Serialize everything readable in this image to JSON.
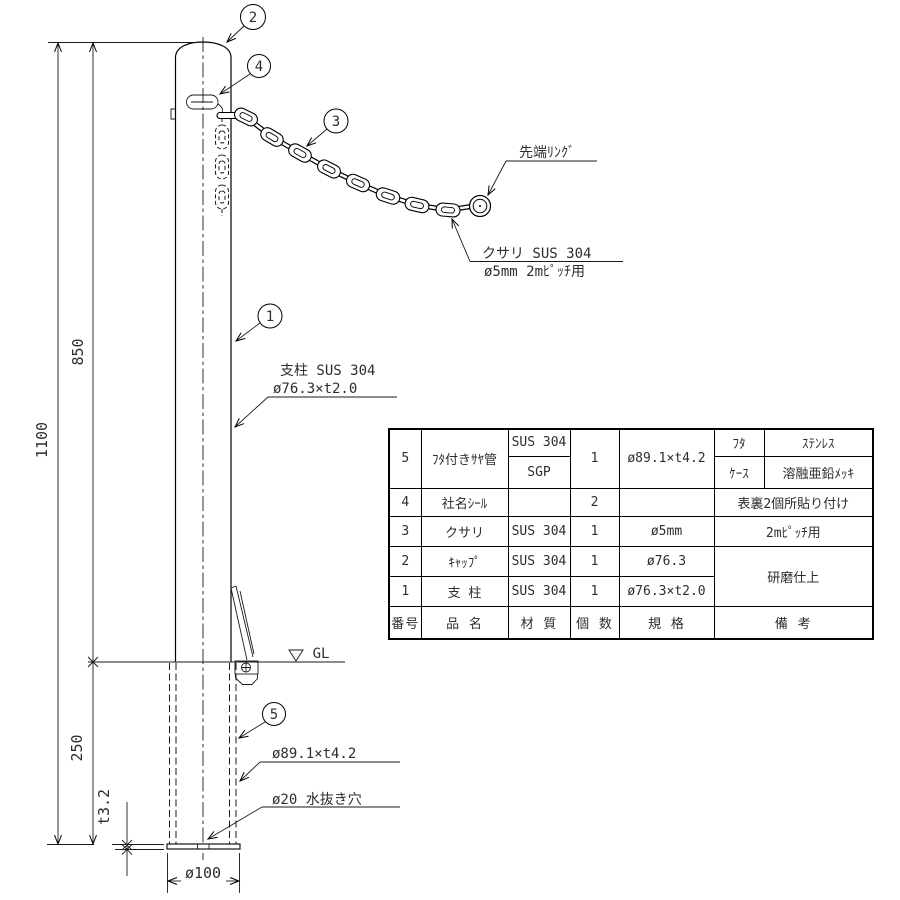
{
  "drawing": {
    "balloons": {
      "b1": "1",
      "b2": "2",
      "b3": "3",
      "b4": "4",
      "b5": "5"
    },
    "dims": {
      "total_height": "1100",
      "above_ground": "850",
      "below_ground": "250",
      "plate_thickness": "t3.2",
      "base_diameter": "ø100"
    },
    "labels": {
      "ground_level": "GL",
      "tip_ring": "先端ﾘﾝｸﾞ",
      "chain_line1": "クサリ SUS 304",
      "chain_line2": "ø5mm 2mﾋﾟｯﾁ用",
      "post_line1": "支柱 SUS 304",
      "post_line2": "ø76.3×t2.0",
      "sleeve_spec": "ø89.1×t4.2",
      "drain_hole": "ø20 水抜き穴"
    }
  },
  "table": {
    "headers": {
      "no": "番号",
      "name": "品  名",
      "material": "材 質",
      "qty": "個 数",
      "spec": "規 格",
      "remarks": "備  考"
    },
    "rows": {
      "r5": {
        "no": "5",
        "name": "ﾌﾀ付きｻﾔ管",
        "mat_top": "SUS 304",
        "mat_bottom": "SGP",
        "qty": "1",
        "spec": "ø89.1×t4.2",
        "rem_label_top": "ﾌﾀ",
        "rem_val_top": "ｽﾃﾝﾚｽ",
        "rem_label_bottom": "ｹｰｽ",
        "rem_val_bottom": "溶融亜鉛ﾒｯｷ"
      },
      "r4": {
        "no": "4",
        "name": "社名ｼｰﾙ",
        "mat": "",
        "qty": "2",
        "spec": "",
        "rem": "表裏2個所貼り付け"
      },
      "r3": {
        "no": "3",
        "name": "クサリ",
        "mat": "SUS 304",
        "qty": "1",
        "spec": "ø5mm",
        "rem": "2mﾋﾟｯﾁ用"
      },
      "r2": {
        "no": "2",
        "name": "ｷｬｯﾌﾟ",
        "mat": "SUS 304",
        "qty": "1",
        "spec": "ø76.3",
        "rem_merged": "研磨仕上"
      },
      "r1": {
        "no": "1",
        "name": "支 柱",
        "mat": "SUS 304",
        "qty": "1",
        "spec": "ø76.3×t2.0"
      }
    }
  }
}
